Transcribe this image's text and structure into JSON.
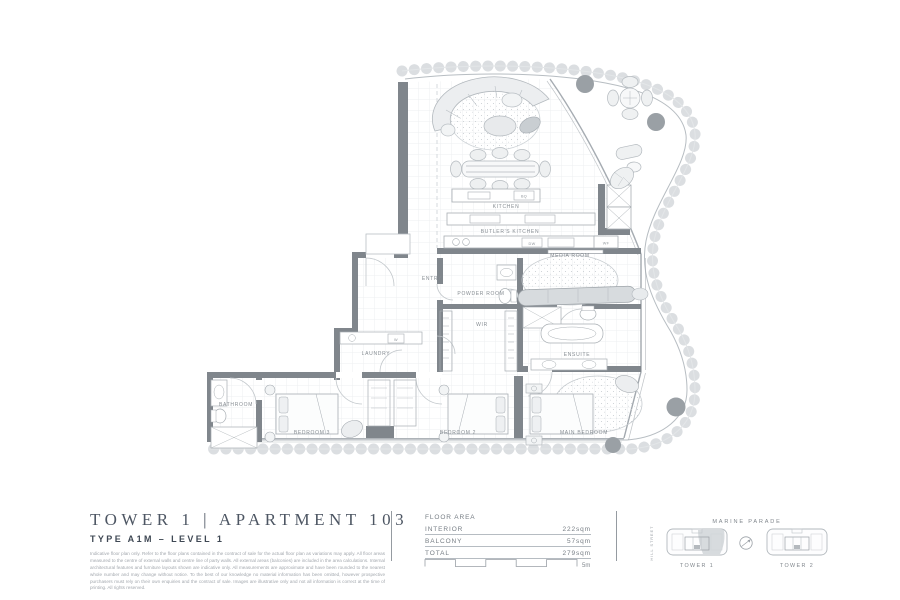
{
  "title_block": {
    "title": "TOWER 1  |  APARTMENT 103",
    "type_line": "TYPE A1M – LEVEL 1",
    "disclaimer": "Indicative floor plan only. Refer to the floor plans contained in the contract of sale for the actual floor plan as variations may apply. All floor areas measured to the centre of external walls and centre line of party walls. All external areas (balconies) are included in the area calculations. Internal architectural features and furniture layouts shown are indicative only. All measurements are approximate and have been rounded to the nearest whole number and may change without notice. To the best of our knowledge no material information has been omitted, however prospective purchasers must rely on their own enquiries and the contract of sale. Images are illustrative only and not all information is correct at the time of printing. All rights reserved."
  },
  "floor_area": {
    "heading": "FLOOR AREA",
    "rows": [
      {
        "label": "INTERIOR",
        "value": "222sqm"
      },
      {
        "label": "BALCONY",
        "value": "57sqm"
      },
      {
        "label": "TOTAL",
        "value": "279sqm"
      }
    ]
  },
  "scale": {
    "label": "5m"
  },
  "locator": {
    "street_top": "MARINE PARADE",
    "street_left": "HILL STREET",
    "tower_1": "TOWER 1",
    "tower_2": "TOWER 2"
  },
  "plan": {
    "rooms": [
      {
        "label": "KITCHEN"
      },
      {
        "label": "BUTLER'S KITCHEN"
      },
      {
        "label": "MEDIA ROOM"
      },
      {
        "label": "ENTRY"
      },
      {
        "label": "POWDER ROOM"
      },
      {
        "label": "WIR"
      },
      {
        "label": "LAUNDRY"
      },
      {
        "label": "ENSUITE"
      },
      {
        "label": "BATHROOM"
      },
      {
        "label": "BEDROOM 3"
      },
      {
        "label": "BEDROOM 2"
      },
      {
        "label": "MAIN BEDROOM"
      }
    ],
    "appliances": {
      "bbq": "BQ",
      "dishwasher": "DW",
      "wine_fridge": "WF",
      "washer": "W"
    }
  },
  "colors": {
    "wall": "#80868c",
    "line": "#b3b9be",
    "planter": "#9aa0a5",
    "title_text": "#4d5663",
    "label_text": "#878d93"
  }
}
